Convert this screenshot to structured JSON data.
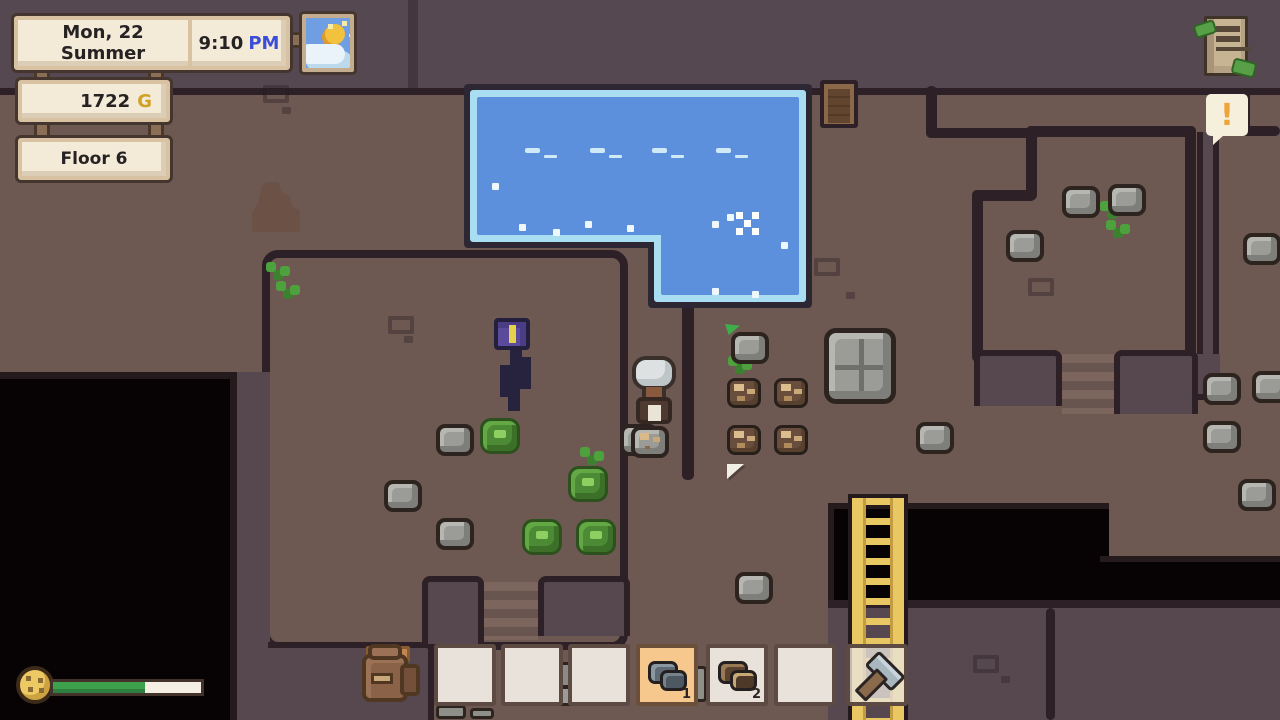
{
  "hud": {
    "date": "Mon, 22 Summer",
    "time": "9:10",
    "meridiem": "PM",
    "gold": "1722",
    "gold_suffix": "G",
    "floor_label": "Floor 6",
    "alert_symbol": "!",
    "stamina_percent": 62,
    "weather_icon": "sun-behind-cloud-icon",
    "board_icon": "quest-board-icon",
    "stamina_icon": "cookie-icon",
    "colors": {
      "meridiem_blue": "#3b4ed8",
      "gold": "#cfa124",
      "panel_cream": "#f3ead8",
      "selected_slot": "#f6c88d",
      "water": "#5c90dc",
      "water_edge": "#a9def2",
      "stamina_fill": "#3da04b",
      "floor": "#6d5852",
      "wall_top": "#574850",
      "outline": "#2d2127"
    }
  },
  "hotbar": {
    "slots": [
      {
        "item": null,
        "count": null,
        "selected": false
      },
      {
        "item": null,
        "count": null,
        "selected": false
      },
      {
        "item": null,
        "count": null,
        "selected": false
      },
      {
        "item": "stone",
        "count": "1",
        "selected": true
      },
      {
        "item": "copper-ore",
        "count": "2",
        "selected": false
      },
      {
        "item": null,
        "count": null,
        "selected": false
      },
      {
        "item": "hammer",
        "count": null,
        "selected": false,
        "translucent": true
      }
    ]
  },
  "scene": {
    "entities": [
      {
        "type": "deco",
        "x": 263,
        "y": 85
      },
      {
        "type": "deco-dot",
        "x": 282,
        "y": 107
      },
      {
        "type": "deco",
        "x": 388,
        "y": 316
      },
      {
        "type": "deco-dot",
        "x": 404,
        "y": 336
      },
      {
        "type": "deco",
        "x": 814,
        "y": 258
      },
      {
        "type": "deco-dot",
        "x": 846,
        "y": 292
      },
      {
        "type": "deco",
        "x": 1028,
        "y": 278
      },
      {
        "type": "deco",
        "x": 973,
        "y": 655
      },
      {
        "type": "deco-dot",
        "x": 1001,
        "y": 676
      },
      {
        "type": "stalagmite",
        "x": 252,
        "y": 182
      },
      {
        "type": "sprout",
        "x": 266,
        "y": 262
      },
      {
        "type": "sprout",
        "x": 276,
        "y": 281
      },
      {
        "type": "sprout",
        "x": 580,
        "y": 447
      },
      {
        "type": "sprout",
        "x": 728,
        "y": 356
      },
      {
        "type": "sprout",
        "x": 1100,
        "y": 201
      },
      {
        "type": "sprout",
        "x": 1106,
        "y": 220
      },
      {
        "type": "water-glint",
        "x": 525,
        "y": 148
      },
      {
        "type": "water-glint",
        "x": 590,
        "y": 148
      },
      {
        "type": "water-glint",
        "x": 652,
        "y": 148
      },
      {
        "type": "water-glint",
        "x": 716,
        "y": 148
      },
      {
        "type": "water-dot",
        "x": 492,
        "y": 183
      },
      {
        "type": "water-dot",
        "x": 519,
        "y": 224
      },
      {
        "type": "water-dot",
        "x": 553,
        "y": 229
      },
      {
        "type": "water-dot",
        "x": 585,
        "y": 221
      },
      {
        "type": "water-dot",
        "x": 627,
        "y": 225
      },
      {
        "type": "water-dot",
        "x": 712,
        "y": 221
      },
      {
        "type": "water-dot",
        "x": 727,
        "y": 214
      },
      {
        "type": "water-dot",
        "x": 781,
        "y": 242
      },
      {
        "type": "water-dot",
        "x": 712,
        "y": 288
      },
      {
        "type": "water-dot",
        "x": 752,
        "y": 291
      },
      {
        "type": "sparkle-x",
        "x": 744,
        "y": 220
      },
      {
        "type": "door",
        "x": 820,
        "y": 80
      },
      {
        "type": "rock",
        "x": 436,
        "y": 424
      },
      {
        "type": "rock",
        "x": 384,
        "y": 480
      },
      {
        "type": "rock",
        "x": 436,
        "y": 518
      },
      {
        "type": "rock",
        "x": 620,
        "y": 424
      },
      {
        "type": "rock",
        "x": 916,
        "y": 422
      },
      {
        "type": "rock",
        "x": 1062,
        "y": 186
      },
      {
        "type": "rock",
        "x": 1108,
        "y": 184
      },
      {
        "type": "rock",
        "x": 1006,
        "y": 230
      },
      {
        "type": "rock",
        "x": 1243,
        "y": 233
      },
      {
        "type": "rock",
        "x": 1203,
        "y": 373
      },
      {
        "type": "rock",
        "x": 1252,
        "y": 371
      },
      {
        "type": "rock",
        "x": 1203,
        "y": 421
      },
      {
        "type": "rock",
        "x": 735,
        "y": 572
      },
      {
        "type": "rock",
        "x": 1238,
        "y": 479
      },
      {
        "type": "rock-flag",
        "x": 731,
        "y": 332
      },
      {
        "type": "rock-speckled",
        "x": 631,
        "y": 426
      },
      {
        "type": "rock-big",
        "x": 824,
        "y": 328
      },
      {
        "type": "copper",
        "x": 727,
        "y": 378
      },
      {
        "type": "copper",
        "x": 774,
        "y": 378
      },
      {
        "type": "copper",
        "x": 727,
        "y": 425
      },
      {
        "type": "copper",
        "x": 774,
        "y": 425
      },
      {
        "type": "plant",
        "x": 480,
        "y": 418
      },
      {
        "type": "plant",
        "x": 568,
        "y": 466
      },
      {
        "type": "plant",
        "x": 522,
        "y": 519
      },
      {
        "type": "plant",
        "x": 576,
        "y": 519
      },
      {
        "type": "flag-marker",
        "x": 727,
        "y": 464
      },
      {
        "type": "monster-plant",
        "x": 492,
        "y": 314
      },
      {
        "type": "npc-elder",
        "x": 630,
        "y": 356
      },
      {
        "type": "path-step",
        "x": 366,
        "y": 646,
        "w": 44,
        "h": 16
      },
      {
        "type": "backpack",
        "x": 360,
        "y": 642
      },
      {
        "type": "anvil",
        "x": 528,
        "y": 662
      },
      {
        "type": "slab",
        "x": 694,
        "y": 666,
        "w": 13,
        "h": 36
      },
      {
        "type": "slab",
        "x": 436,
        "y": 705,
        "w": 30,
        "h": 14
      },
      {
        "type": "slab",
        "x": 470,
        "y": 708,
        "w": 24,
        "h": 11
      }
    ]
  }
}
